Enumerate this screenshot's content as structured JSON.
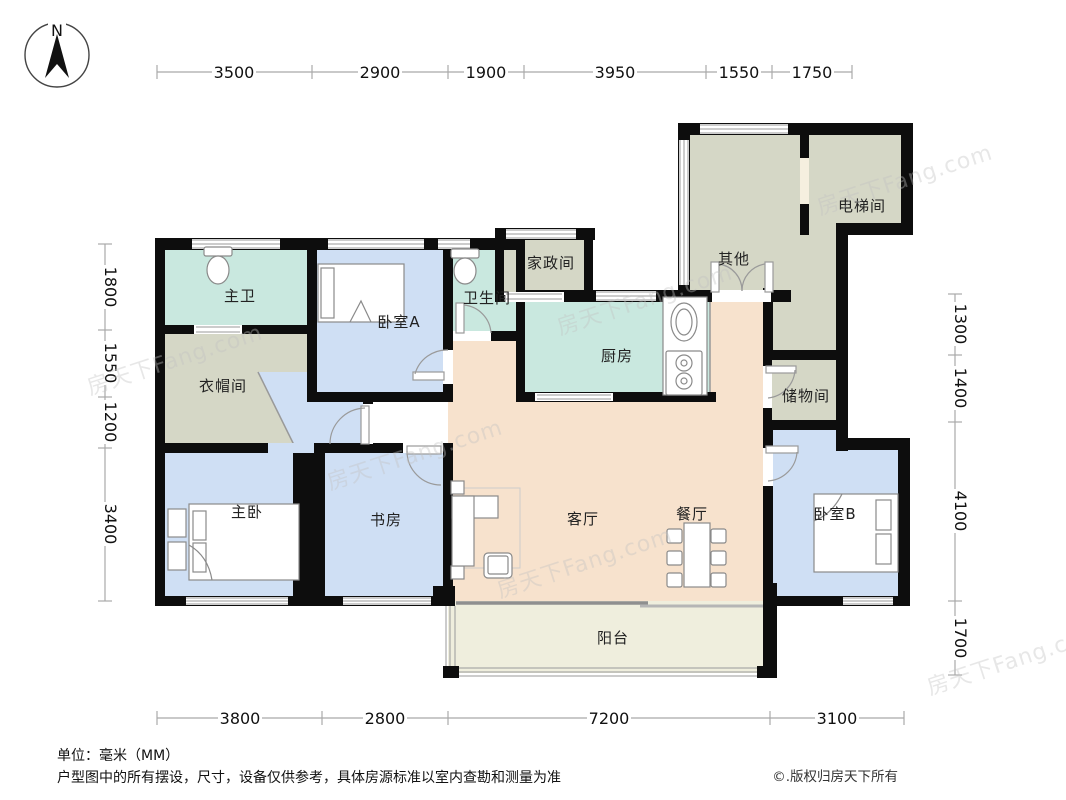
{
  "title": "户型图",
  "compass": {
    "label": "N"
  },
  "watermark": {
    "text": "房天下Fang.com"
  },
  "colors": {
    "wall": "#0d0d0d",
    "bath_teal": "#c9e8df",
    "bedroom_blue": "#cfdff4",
    "utility_gray": "#d5d7c6",
    "living_peach": "#f7e2cd",
    "balcony_cream": "#efeedd"
  },
  "rooms": [
    {
      "id": "master-bath",
      "label": "主卫"
    },
    {
      "id": "cloakroom",
      "label": "衣帽间"
    },
    {
      "id": "bedroom-a",
      "label": "卧室A"
    },
    {
      "id": "bathroom",
      "label": "卫生间"
    },
    {
      "id": "housekeeping",
      "label": "家政间"
    },
    {
      "id": "other",
      "label": "其他"
    },
    {
      "id": "elevator",
      "label": "电梯间"
    },
    {
      "id": "kitchen",
      "label": "厨房"
    },
    {
      "id": "storage",
      "label": "储物间"
    },
    {
      "id": "master-bedroom",
      "label": "主卧"
    },
    {
      "id": "study",
      "label": "书房"
    },
    {
      "id": "living-room",
      "label": "客厅"
    },
    {
      "id": "dining-room",
      "label": "餐厅"
    },
    {
      "id": "bedroom-b",
      "label": "卧室B"
    },
    {
      "id": "balcony",
      "label": "阳台"
    }
  ],
  "dimensions": {
    "unit": "mm",
    "top": [
      {
        "value": "3500"
      },
      {
        "value": "2900"
      },
      {
        "value": "1900"
      },
      {
        "value": "3950"
      },
      {
        "value": "1550"
      },
      {
        "value": "1750"
      }
    ],
    "left": [
      {
        "value": "1800"
      },
      {
        "value": "1550"
      },
      {
        "value": "1200"
      },
      {
        "value": "3400"
      }
    ],
    "right": [
      {
        "value": "1300"
      },
      {
        "value": "1400"
      },
      {
        "value": "4100"
      },
      {
        "value": "1700"
      }
    ],
    "bottom": [
      {
        "value": "3800"
      },
      {
        "value": "2800"
      },
      {
        "value": "7200"
      },
      {
        "value": "3100"
      }
    ]
  },
  "footer": {
    "unit": "单位：毫米（MM）",
    "disclaimer": "户型图中的所有摆设，尺寸，设备仅供参考，具体房源标准以室内查勘和测量为准",
    "copyright": "©.版权归房天下所有"
  }
}
